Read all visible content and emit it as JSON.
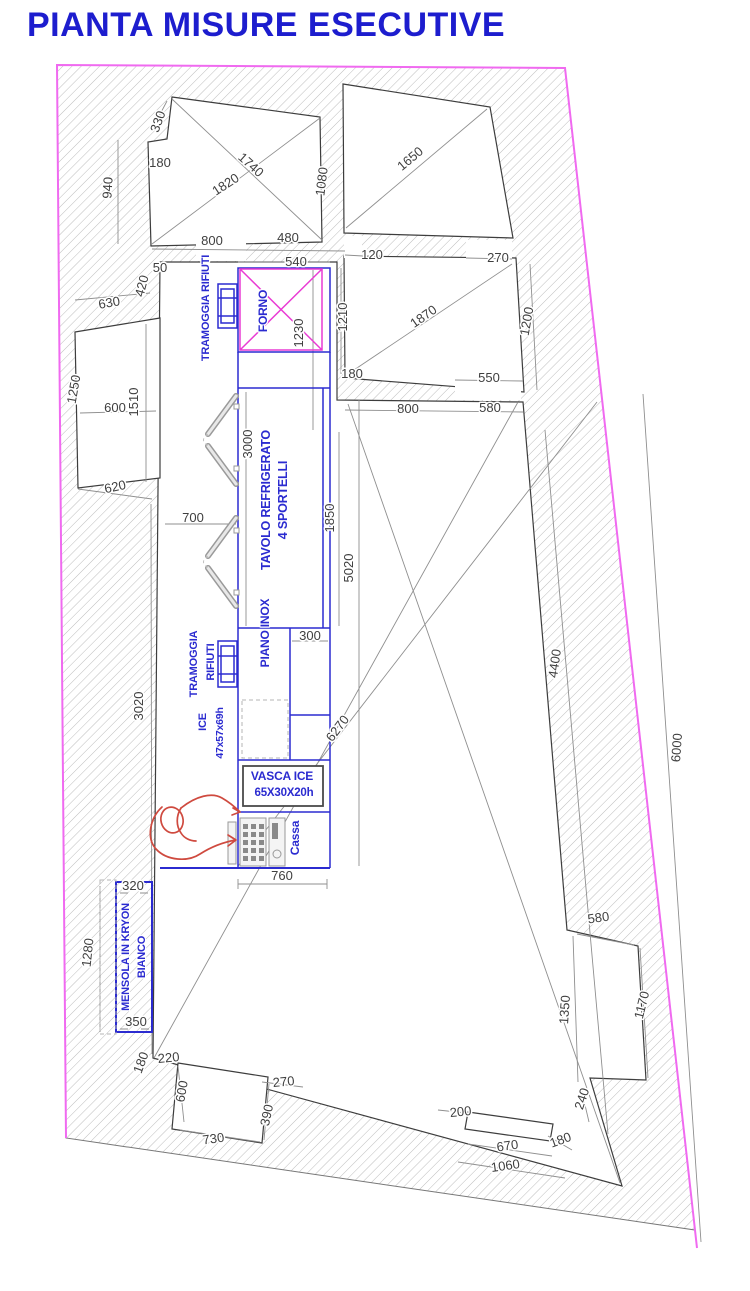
{
  "title": "PIANTA MISURE ESECUTIVE",
  "colors": {
    "title_blue": "#1d1dce",
    "equipment_blue": "#2b2bd0",
    "forno_magenta": "#e93bd4",
    "boundary_magenta": "#f06af0",
    "dimension_gray": "#3f3f3f",
    "person_red": "#cf4a3f"
  },
  "dimensions": [
    {
      "v": "330",
      "x": 162,
      "y": 123,
      "r": -70
    },
    {
      "v": "180",
      "x": 160,
      "y": 167,
      "r": 0
    },
    {
      "v": "940",
      "x": 112,
      "y": 188,
      "r": -87
    },
    {
      "v": "1740",
      "x": 248,
      "y": 168,
      "r": 42
    },
    {
      "v": "1820",
      "x": 228,
      "y": 188,
      "r": -33
    },
    {
      "v": "1080",
      "x": 326,
      "y": 182,
      "r": -83
    },
    {
      "v": "800",
      "x": 212,
      "y": 245,
      "r": 0
    },
    {
      "v": "480",
      "x": 288,
      "y": 242,
      "r": 0
    },
    {
      "v": "1650",
      "x": 413,
      "y": 162,
      "r": -40
    },
    {
      "v": "120",
      "x": 372,
      "y": 259,
      "r": 0
    },
    {
      "v": "270",
      "x": 498,
      "y": 262,
      "r": 0
    },
    {
      "v": "50",
      "x": 160,
      "y": 272,
      "r": 0
    },
    {
      "v": "420",
      "x": 146,
      "y": 287,
      "r": -75
    },
    {
      "v": "630",
      "x": 110,
      "y": 307,
      "r": -10
    },
    {
      "v": "540",
      "x": 296,
      "y": 266,
      "r": 0
    },
    {
      "v": "1230",
      "x": 303,
      "y": 333,
      "r": -90
    },
    {
      "v": "1210",
      "x": 347,
      "y": 317,
      "r": -90
    },
    {
      "v": "180",
      "x": 352,
      "y": 378,
      "r": 0
    },
    {
      "v": "1870",
      "x": 426,
      "y": 320,
      "r": -35
    },
    {
      "v": "1200",
      "x": 531,
      "y": 322,
      "r": -80
    },
    {
      "v": "550",
      "x": 489,
      "y": 382,
      "r": 0
    },
    {
      "v": "800",
      "x": 408,
      "y": 413,
      "r": 0
    },
    {
      "v": "580",
      "x": 490,
      "y": 412,
      "r": 0
    },
    {
      "v": "600",
      "x": 115,
      "y": 412,
      "r": 0
    },
    {
      "v": "1510",
      "x": 138,
      "y": 402,
      "r": -90
    },
    {
      "v": "620",
      "x": 116,
      "y": 491,
      "r": -12
    },
    {
      "v": "1250",
      "x": 78,
      "y": 390,
      "r": -80
    },
    {
      "v": "3000",
      "x": 252,
      "y": 444,
      "r": -90
    },
    {
      "v": "700",
      "x": 193,
      "y": 522,
      "r": 0
    },
    {
      "v": "1850",
      "x": 334,
      "y": 518,
      "r": -90
    },
    {
      "v": "5020",
      "x": 353,
      "y": 568,
      "r": -90
    },
    {
      "v": "3020",
      "x": 143,
      "y": 706,
      "r": -90
    },
    {
      "v": "300",
      "x": 310,
      "y": 640,
      "r": 0
    },
    {
      "v": "6270",
      "x": 341,
      "y": 731,
      "r": -53
    },
    {
      "v": "4400",
      "x": 559,
      "y": 664,
      "r": -82
    },
    {
      "v": "6000",
      "x": 681,
      "y": 748,
      "r": -86
    },
    {
      "v": "760",
      "x": 282,
      "y": 880,
      "r": 0
    },
    {
      "v": "320",
      "x": 133,
      "y": 890,
      "r": 0
    },
    {
      "v": "1280",
      "x": 92,
      "y": 953,
      "r": -84
    },
    {
      "v": "350",
      "x": 136,
      "y": 1026,
      "r": 0
    },
    {
      "v": "580",
      "x": 599,
      "y": 922,
      "r": -8
    },
    {
      "v": "1170",
      "x": 646,
      "y": 1006,
      "r": -76
    },
    {
      "v": "1350",
      "x": 569,
      "y": 1010,
      "r": -86
    },
    {
      "v": "180",
      "x": 145,
      "y": 1064,
      "r": -70
    },
    {
      "v": "220",
      "x": 169,
      "y": 1062,
      "r": -5
    },
    {
      "v": "600",
      "x": 186,
      "y": 1092,
      "r": -80
    },
    {
      "v": "270",
      "x": 284,
      "y": 1086,
      "r": -5
    },
    {
      "v": "390",
      "x": 271,
      "y": 1116,
      "r": -78
    },
    {
      "v": "730",
      "x": 214,
      "y": 1143,
      "r": -8
    },
    {
      "v": "200",
      "x": 461,
      "y": 1116,
      "r": -6
    },
    {
      "v": "240",
      "x": 586,
      "y": 1100,
      "r": -72
    },
    {
      "v": "670",
      "x": 508,
      "y": 1150,
      "r": -8
    },
    {
      "v": "180",
      "x": 562,
      "y": 1144,
      "r": -20
    },
    {
      "v": "1060",
      "x": 506,
      "y": 1170,
      "r": -8
    }
  ],
  "equipment_labels": [
    {
      "t": "TRAMOGGIA RIFIUTI",
      "x": 209,
      "y": 308,
      "r": -90,
      "s": 11
    },
    {
      "t": "FORNO",
      "x": 267,
      "y": 311,
      "r": -90,
      "s": 12,
      "c": "magenta"
    },
    {
      "t": "TAVOLO REFRIGERATO",
      "x": 270,
      "y": 500,
      "r": -90,
      "s": 12.5
    },
    {
      "t": "4 SPORTELLI",
      "x": 287,
      "y": 500,
      "r": -90,
      "s": 12.5
    },
    {
      "t": "PIANO INOX",
      "x": 269,
      "y": 633,
      "r": -90,
      "s": 12
    },
    {
      "t": "TRAMOGGIA",
      "x": 197,
      "y": 664,
      "r": -90,
      "s": 11
    },
    {
      "t": "RIFIUTI",
      "x": 214,
      "y": 662,
      "r": -90,
      "s": 11
    },
    {
      "t": "ICE",
      "x": 206,
      "y": 722,
      "r": -90,
      "s": 11
    },
    {
      "t": "47x57x69h",
      "x": 223,
      "y": 733,
      "r": -90,
      "s": 10.5
    },
    {
      "t": "VASCA ICE",
      "x": 282,
      "y": 780,
      "r": 0,
      "s": 12
    },
    {
      "t": "65X30X20h",
      "x": 284,
      "y": 796,
      "r": 0,
      "s": 11.5
    },
    {
      "t": "Cassa",
      "x": 299,
      "y": 838,
      "r": -90,
      "s": 12
    },
    {
      "t": "MENSOLA IN KRYON",
      "x": 129,
      "y": 957,
      "r": -90,
      "s": 11
    },
    {
      "t": "BIANCO",
      "x": 145,
      "y": 957,
      "r": -90,
      "s": 11
    }
  ]
}
